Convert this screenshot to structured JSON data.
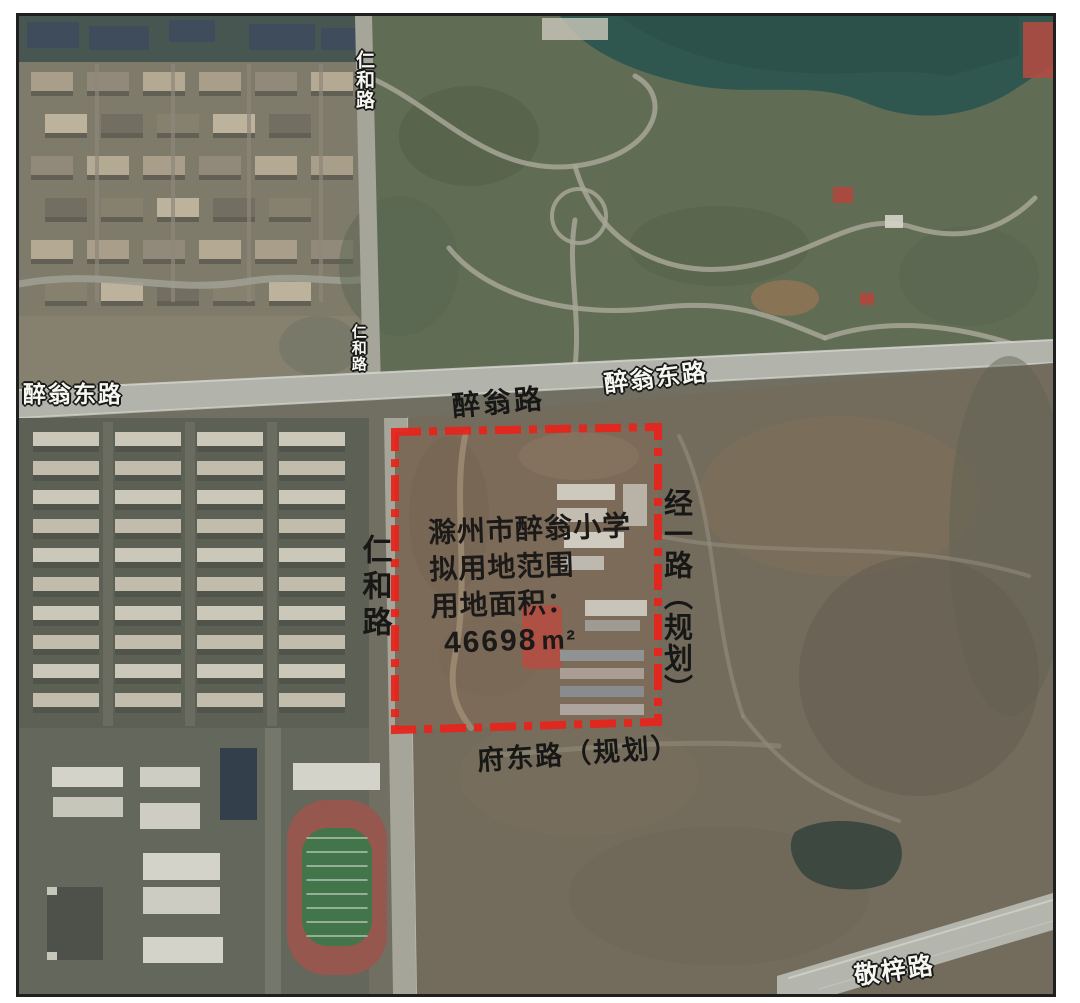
{
  "colors": {
    "page_bg": "#ffffff",
    "frame_border": "#1f1f1f",
    "boundary_red": "#e8231a",
    "road_gray": "#b2b4ad",
    "park_green": "#5c684f",
    "lake_teal": "#27514a",
    "urban_base": "#7c7767",
    "residential_ground": "#585c50",
    "campus_ground": "#5f6257",
    "terrain": "#6f6859",
    "site_brown": "#7a6655",
    "track_red": "#935149",
    "field_green": "#3c7144",
    "label_black": "#171715",
    "label_white": "#f6f6f1"
  },
  "map": {
    "road_labels": {
      "zuiweng_east_west": "醉翁东路",
      "zuiweng": "醉翁路",
      "zuiweng_east_east": "醉翁东路",
      "renhe_small_top": "仁和路",
      "renhe_small_mid": "仁和路",
      "renhe": "仁和路",
      "jingyi_planned": "经一路（规划）",
      "fudong_planned": "府东路（规划）",
      "jingzi": "敬梓路"
    },
    "site_annotation": {
      "line1": "滁州市醉翁小学",
      "line2": "拟用地范围",
      "line3": "用地面积：",
      "area_value": "46698",
      "area_unit": "m²"
    }
  }
}
